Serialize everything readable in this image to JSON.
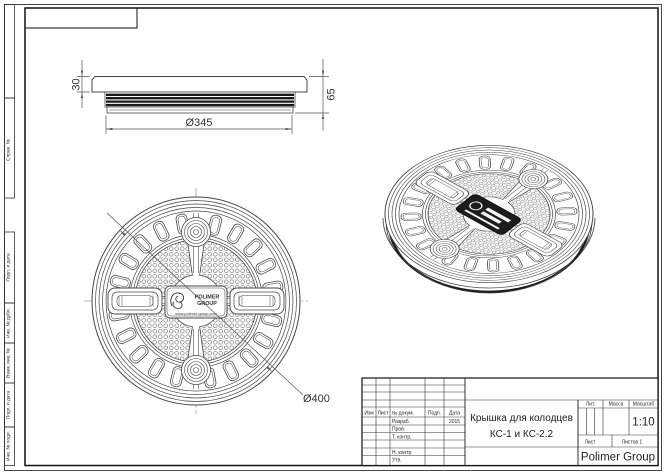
{
  "colors": {
    "paper": "#ffffff",
    "line": "#474747",
    "dark_line": "#1b1b1b",
    "text": "#222222"
  },
  "margin_labels": [
    "Справ. №",
    "Подп. и дата",
    "Инв. № дубл.",
    "Взам. инв. №",
    "Подп. и дата",
    "Инв. № подл."
  ],
  "side_view": {
    "dim_cap_height": "30",
    "dim_total_height": "65",
    "dim_diameter": "Ø345"
  },
  "plan_view": {
    "dim_diameter": "Ø400"
  },
  "logo": {
    "line1": "POLIMER",
    "line2": "GROUP",
    "website": "www.polimer-group.com"
  },
  "title_block": {
    "col_izm": "Изм",
    "col_list": "Лист",
    "col_doc": "№ докум.",
    "col_sign": "Подп.",
    "col_date": "Дата",
    "row_developed": "Разраб.",
    "row_checked": "Пров.",
    "row_tcontrol": "Т. контр.",
    "row_ncontrol": "Н. контр.",
    "row_approved": "Утв.",
    "date_value": "2015",
    "title_line1": "Крышка для колодцев",
    "title_line2": "КС-1 и КС-2.2",
    "lit_label": "Лит.",
    "mass_label": "Масса",
    "scale_label": "Масштаб",
    "scale_value": "1:10",
    "sheet_label": "Лист",
    "sheets_label": "Листов 1",
    "company": "Polimer Group"
  }
}
